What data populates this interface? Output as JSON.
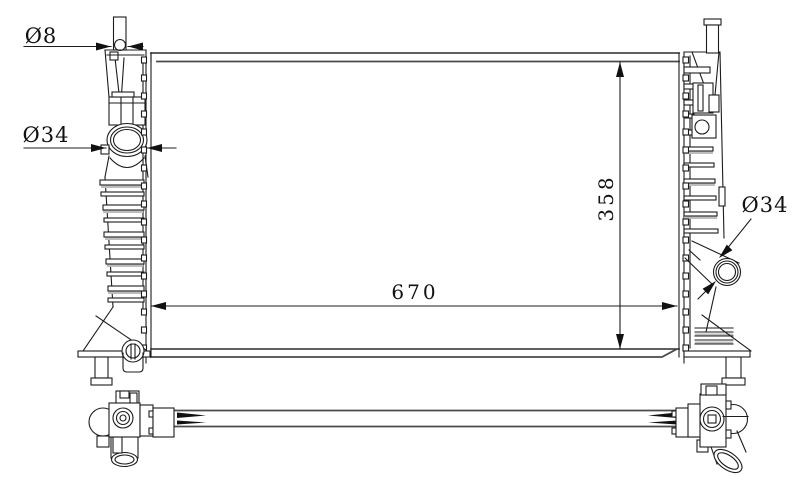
{
  "page": {
    "background_color": "#ffffff",
    "line_color": "#1c1c1c"
  },
  "drawing": {
    "dimensions": {
      "bleed_port_diameter": "Ø8",
      "inlet_port_diameter": "Ø34",
      "core_width": "670",
      "core_height": "358",
      "outlet_port_diameter": "Ø34"
    }
  }
}
